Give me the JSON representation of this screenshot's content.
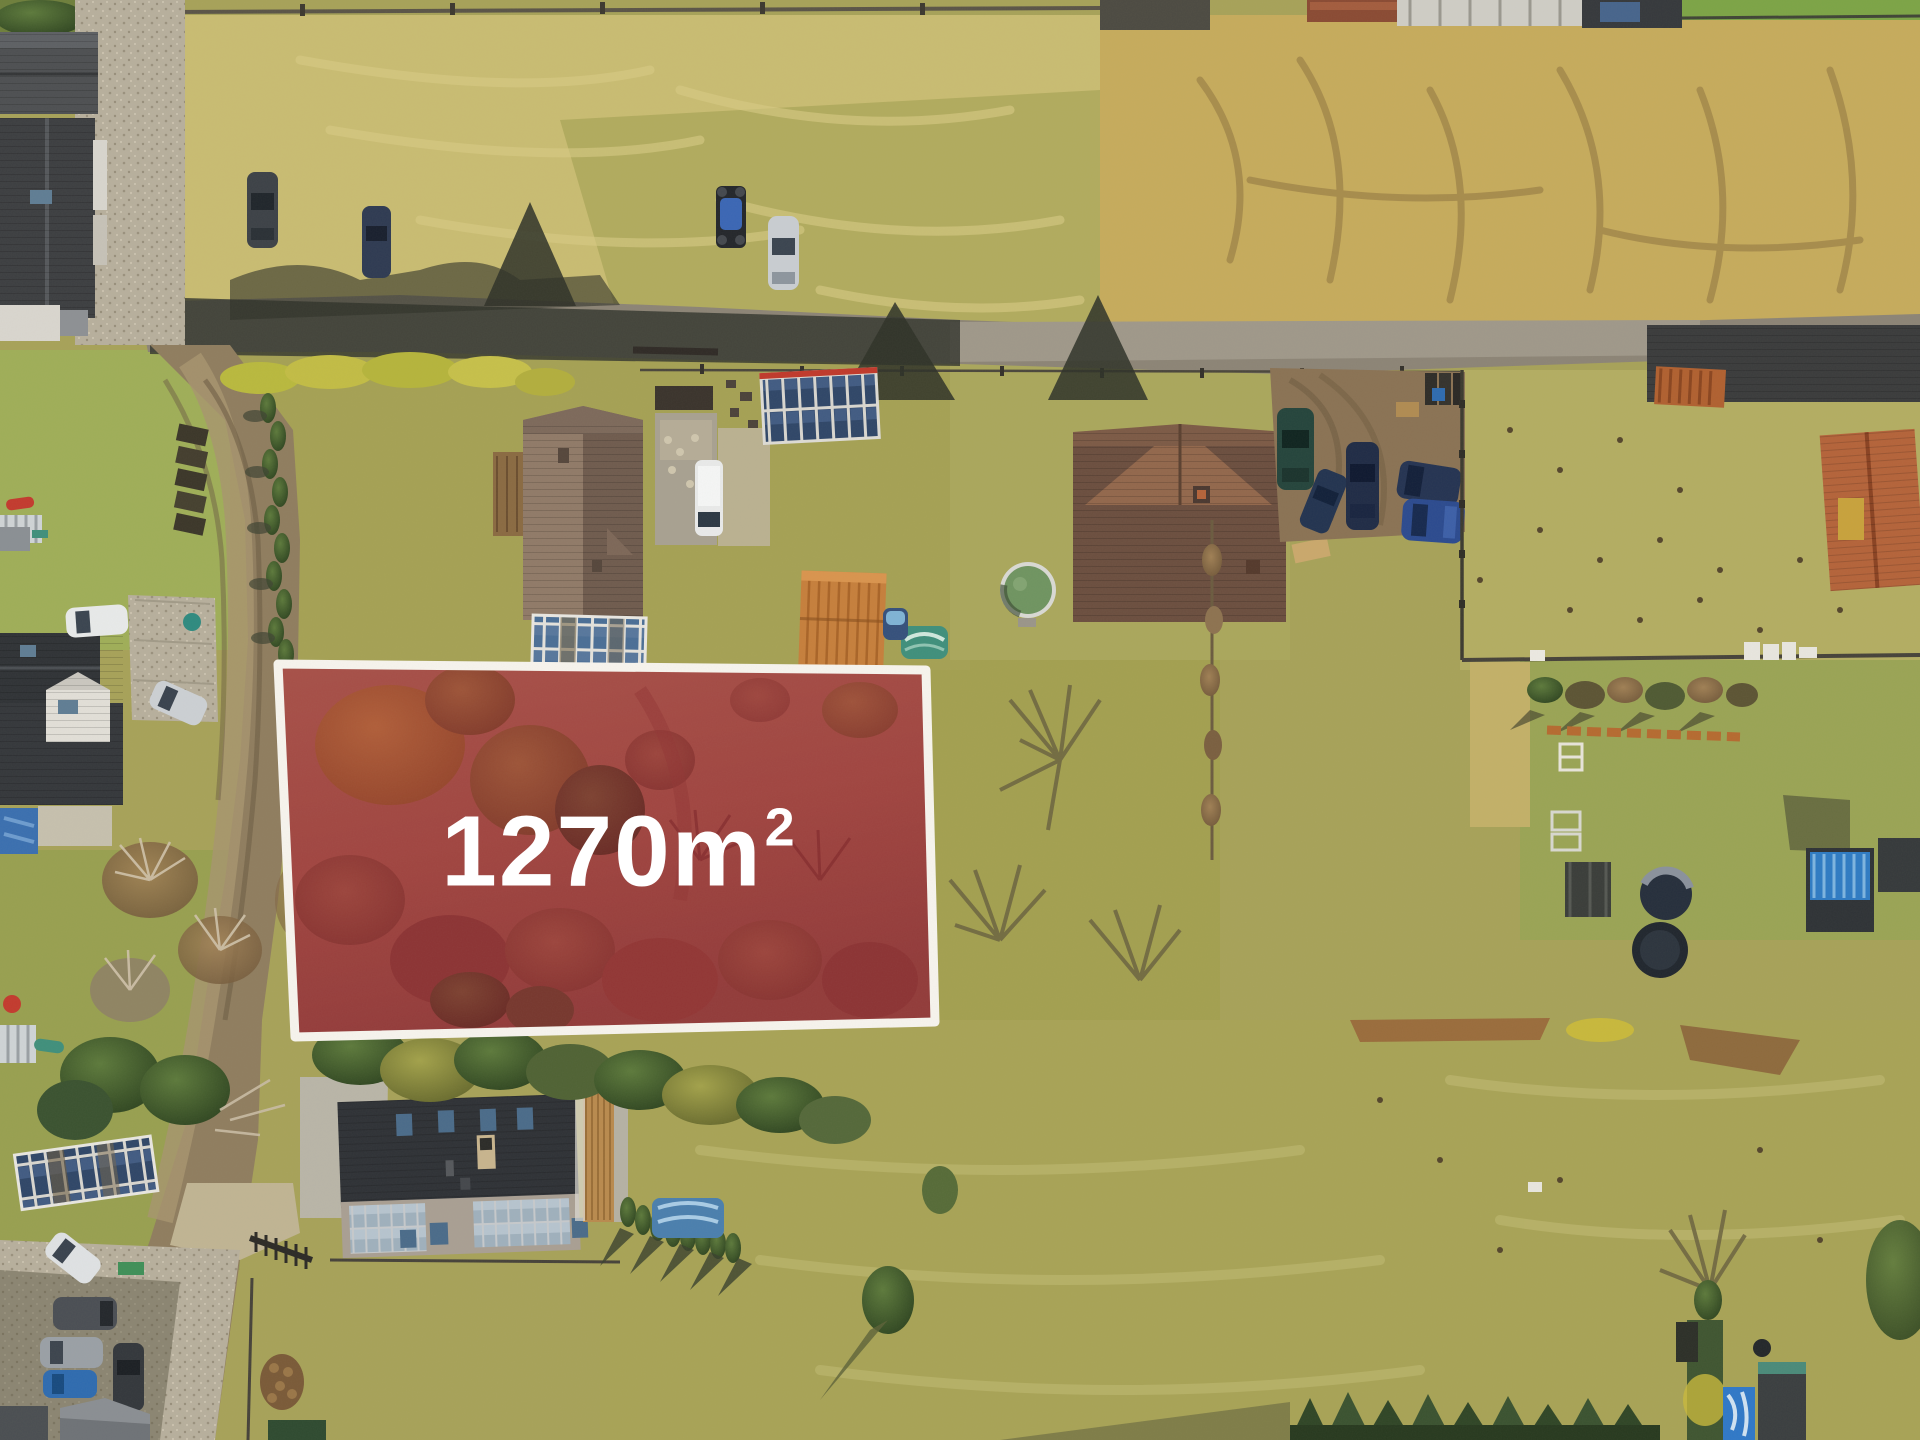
{
  "plot_overlay": {
    "area_value": "1270m",
    "area_sup": "2",
    "full_label": "1270m²",
    "fill_color": "#99142a",
    "border_color": "#f7f4ee",
    "text_color": "#ffffff"
  },
  "scene": {
    "kind": "aerial-drone-photo-of-building-plot",
    "season": "early-spring",
    "palette": {
      "dry_grass": "#c9bc72",
      "golden_field": "#c6ab5c",
      "green_lawn": "#9aa455",
      "road_shadowed": "#3d3f36",
      "road_sunlit": "#9a9285",
      "dirt_road": "#8f7d5f",
      "dark_roof": "#2e3136",
      "brown_roof": "#84705f",
      "terracotta_roof": "#b4633a",
      "solar_panel": "#3a5070",
      "pool_cover": "#6f9461"
    }
  }
}
